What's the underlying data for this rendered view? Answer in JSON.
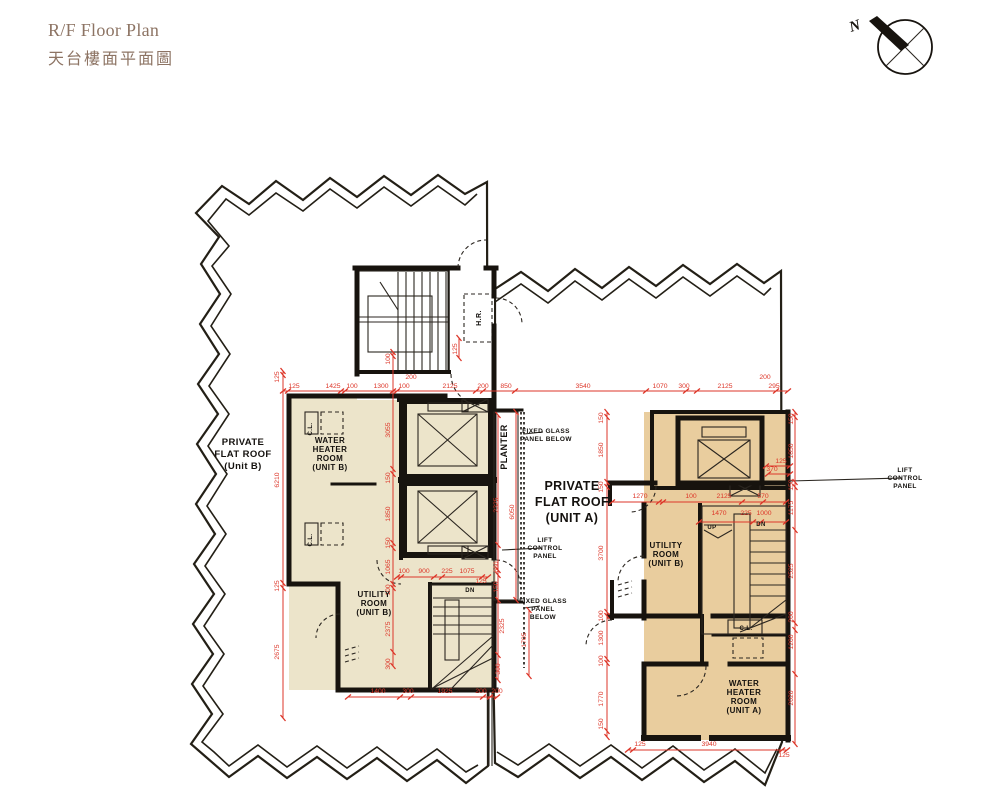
{
  "page": {
    "title_en": "R/F Floor Plan",
    "title_zh": "天台樓面平面圖",
    "north_label": "N"
  },
  "colors": {
    "roof_unit_b_fill": "#ece4ca",
    "roof_unit_a_fill": "#e9cd9e",
    "dimension_red": "#dd3629",
    "wall_black": "#17130e",
    "title_brown": "#8d7464"
  },
  "labels": [
    {
      "t": "PRIVATE\nFLAT ROOF\n(Unit B)",
      "x": 243,
      "y": 445,
      "s": 9.5,
      "lh": 12,
      "n": "label-private-flat-roof-b"
    },
    {
      "t": "WATER\nHEATER\nROOM\n(UNIT B)",
      "x": 330,
      "y": 443,
      "s": 8,
      "lh": 9,
      "n": "label-water-heater-room-b"
    },
    {
      "t": "UTILITY\nROOM\n(UNIT B)",
      "x": 374,
      "y": 597,
      "s": 8,
      "lh": 9,
      "n": "label-utility-room-b-left"
    },
    {
      "t": "PRIVATE\nFLAT ROOF\n(UNIT A)",
      "x": 572,
      "y": 490,
      "s": 12.5,
      "lh": 16,
      "n": "label-private-flat-roof-a"
    },
    {
      "t": "UTILITY\nROOM\n(UNIT B)",
      "x": 666,
      "y": 548,
      "s": 8,
      "lh": 9,
      "n": "label-utility-room-b-right"
    },
    {
      "t": "WATER\nHEATER\nROOM\n(UNIT A)",
      "x": 744,
      "y": 686,
      "s": 8,
      "lh": 9,
      "n": "label-water-heater-room-a"
    },
    {
      "t": "PLANTER",
      "x": 507,
      "y": 447,
      "r": 90,
      "s": 9,
      "n": "label-planter"
    },
    {
      "t": "H.R.",
      "x": 481,
      "y": 318,
      "r": 90,
      "s": 7,
      "n": "label-hose-reel"
    },
    {
      "t": "C.L.",
      "x": 312,
      "y": 429,
      "r": 90,
      "s": 6,
      "n": "label-cl-whrb-1"
    },
    {
      "t": "C.L.",
      "x": 312,
      "y": 540,
      "r": 90,
      "s": 6,
      "n": "label-cl-whrb-2"
    },
    {
      "t": "C.L.",
      "x": 746,
      "y": 630,
      "s": 6,
      "n": "label-cl-unit-a"
    },
    {
      "t": "UP",
      "x": 712,
      "y": 529,
      "s": 6,
      "n": "label-stair-up"
    },
    {
      "t": "DN",
      "x": 761,
      "y": 526,
      "s": 6,
      "n": "label-stair-dn-right"
    },
    {
      "t": "DN",
      "x": 470,
      "y": 592,
      "s": 6,
      "n": "label-stair-dn-left"
    },
    {
      "t": "FIXED GLASS\nPANEL BELOW",
      "x": 546,
      "y": 433,
      "s": 6.5,
      "lh": 8,
      "a": "start",
      "n": "label-fixed-glass-top"
    },
    {
      "t": "FIXED GLASS\nPANEL\nBELOW",
      "x": 543,
      "y": 603,
      "s": 6.5,
      "lh": 8,
      "a": "start",
      "n": "label-fixed-glass-bottom"
    },
    {
      "t": "LIFT\nCONTROL\nPANEL",
      "x": 545,
      "y": 542,
      "s": 6.5,
      "lh": 8,
      "a": "start",
      "n": "label-lift-control-left"
    },
    {
      "t": "LIFT\nCONTROL\nPANEL",
      "x": 905,
      "y": 472,
      "s": 6.5,
      "lh": 8,
      "a": "start",
      "n": "label-lift-control-right"
    }
  ],
  "dims": [
    {
      "t": "125",
      "x": 294,
      "y": 388
    },
    {
      "t": "1425",
      "x": 333,
      "y": 388
    },
    {
      "t": "100",
      "x": 352,
      "y": 388
    },
    {
      "t": "1300",
      "x": 381,
      "y": 388
    },
    {
      "t": "100",
      "x": 404,
      "y": 388
    },
    {
      "t": "200",
      "x": 411,
      "y": 379
    },
    {
      "t": "2125",
      "x": 450,
      "y": 388
    },
    {
      "t": "200",
      "x": 483,
      "y": 388
    },
    {
      "t": "850",
      "x": 506,
      "y": 388
    },
    {
      "t": "3540",
      "x": 583,
      "y": 388
    },
    {
      "t": "1070",
      "x": 660,
      "y": 388
    },
    {
      "t": "300",
      "x": 684,
      "y": 388
    },
    {
      "t": "2125",
      "x": 725,
      "y": 388
    },
    {
      "t": "200",
      "x": 765,
      "y": 379
    },
    {
      "t": "295",
      "x": 774,
      "y": 388
    },
    {
      "t": "125",
      "x": 279,
      "y": 377,
      "r": 90
    },
    {
      "t": "6210",
      "x": 279,
      "y": 480,
      "r": 90
    },
    {
      "t": "125",
      "x": 279,
      "y": 586,
      "r": 90
    },
    {
      "t": "2675",
      "x": 279,
      "y": 652,
      "r": 90
    },
    {
      "t": "100",
      "x": 390,
      "y": 359,
      "r": 90
    },
    {
      "t": "3055",
      "x": 390,
      "y": 430,
      "r": 90
    },
    {
      "t": "150",
      "x": 390,
      "y": 478,
      "r": 90
    },
    {
      "t": "1850",
      "x": 390,
      "y": 514,
      "r": 90
    },
    {
      "t": "150",
      "x": 390,
      "y": 543,
      "r": 90
    },
    {
      "t": "1065",
      "x": 390,
      "y": 567,
      "r": 90
    },
    {
      "t": "100",
      "x": 390,
      "y": 590,
      "r": 90
    },
    {
      "t": "2375",
      "x": 390,
      "y": 629,
      "r": 90
    },
    {
      "t": "300",
      "x": 390,
      "y": 664,
      "r": 90
    },
    {
      "t": "100",
      "x": 404,
      "y": 573
    },
    {
      "t": "900",
      "x": 424,
      "y": 573
    },
    {
      "t": "225",
      "x": 447,
      "y": 573
    },
    {
      "t": "1075",
      "x": 467,
      "y": 573
    },
    {
      "t": "125",
      "x": 481,
      "y": 583
    },
    {
      "t": "2325",
      "x": 498,
      "y": 505,
      "r": 90
    },
    {
      "t": "680",
      "x": 498,
      "y": 567,
      "r": 90
    },
    {
      "t": "150",
      "x": 498,
      "y": 587,
      "r": 90
    },
    {
      "t": "2325",
      "x": 504,
      "y": 626,
      "r": 90
    },
    {
      "t": "300",
      "x": 500,
      "y": 669,
      "r": 90
    },
    {
      "t": "6050",
      "x": 514,
      "y": 512,
      "r": 90
    },
    {
      "t": "1705",
      "x": 526,
      "y": 640,
      "r": 90
    },
    {
      "t": "1400",
      "x": 378,
      "y": 693
    },
    {
      "t": "300",
      "x": 408,
      "y": 693
    },
    {
      "t": "1925",
      "x": 445,
      "y": 693
    },
    {
      "t": "200",
      "x": 481,
      "y": 693
    },
    {
      "t": "200",
      "x": 497,
      "y": 693
    },
    {
      "t": "125",
      "x": 457,
      "y": 349,
      "r": 90
    },
    {
      "t": "1270",
      "x": 640,
      "y": 498
    },
    {
      "t": "100",
      "x": 691,
      "y": 498
    },
    {
      "t": "2125",
      "x": 724,
      "y": 498
    },
    {
      "t": "570",
      "x": 763,
      "y": 498
    },
    {
      "t": "125",
      "x": 781,
      "y": 463
    },
    {
      "t": "370",
      "x": 772,
      "y": 471
    },
    {
      "t": "1470",
      "x": 719,
      "y": 515
    },
    {
      "t": "225",
      "x": 746,
      "y": 515
    },
    {
      "t": "1000",
      "x": 764,
      "y": 515
    },
    {
      "t": "150",
      "x": 603,
      "y": 418,
      "r": 90
    },
    {
      "t": "1850",
      "x": 603,
      "y": 450,
      "r": 90
    },
    {
      "t": "150",
      "x": 603,
      "y": 487,
      "r": 90
    },
    {
      "t": "3700",
      "x": 603,
      "y": 553,
      "r": 90
    },
    {
      "t": "100",
      "x": 603,
      "y": 616,
      "r": 90
    },
    {
      "t": "1300",
      "x": 603,
      "y": 638,
      "r": 90
    },
    {
      "t": "100",
      "x": 603,
      "y": 661,
      "r": 90
    },
    {
      "t": "1770",
      "x": 603,
      "y": 699,
      "r": 90
    },
    {
      "t": "150",
      "x": 603,
      "y": 724,
      "r": 90
    },
    {
      "t": "150",
      "x": 793,
      "y": 419,
      "r": 90
    },
    {
      "t": "1850",
      "x": 793,
      "y": 451,
      "r": 90
    },
    {
      "t": "150",
      "x": 793,
      "y": 485,
      "r": 90
    },
    {
      "t": "1175",
      "x": 793,
      "y": 508,
      "r": 90
    },
    {
      "t": "2525",
      "x": 793,
      "y": 571,
      "r": 90
    },
    {
      "t": "200",
      "x": 793,
      "y": 617,
      "r": 90
    },
    {
      "t": "1200",
      "x": 793,
      "y": 642,
      "r": 90
    },
    {
      "t": "2020",
      "x": 793,
      "y": 698,
      "r": 90
    },
    {
      "t": "125",
      "x": 640,
      "y": 746
    },
    {
      "t": "3940",
      "x": 709,
      "y": 746
    },
    {
      "t": "125",
      "x": 784,
      "y": 757
    }
  ]
}
